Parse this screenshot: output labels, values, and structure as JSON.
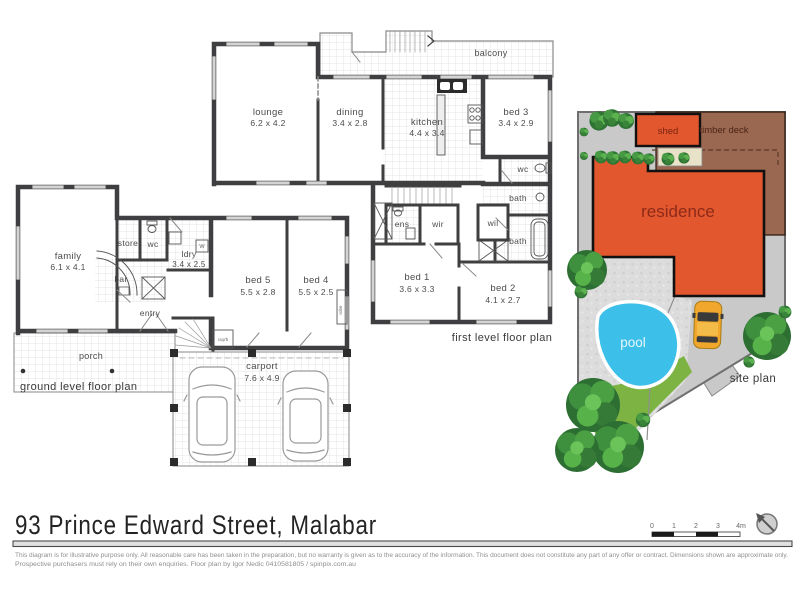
{
  "page": {
    "title": "93 Prince Edward Street, Malabar",
    "disclaimer_line1": "This diagram is for illustrative purpose only. All reasonable care has been taken in the preparation, but no warranty is given as to the accuracy of the information. This document does not constitute any part of any offer or contract. Dimensions shown are approximate only.",
    "disclaimer_line2": "Prospective purchasers must rely on their own enquiries. Floor plan by Igor Nedic 0410581805 / spinpix.com.au"
  },
  "ground_plan": {
    "label": "ground level floor plan",
    "family": {
      "name": "family",
      "dims": "6.1 x 4.1"
    },
    "store": {
      "name": "store"
    },
    "wc": {
      "name": "wc"
    },
    "ldry": {
      "name": "ldry",
      "dims": "3.4 x 2.5"
    },
    "bar": {
      "name": "bar"
    },
    "entry": {
      "name": "entry"
    },
    "porch": {
      "name": "porch"
    },
    "bed5": {
      "name": "bed 5",
      "dims": "5.5 x 2.8"
    },
    "bed4": {
      "name": "bed 4",
      "dims": "5.5 x 2.5"
    },
    "carport": {
      "name": "carport",
      "dims": "7.6 x 4.9"
    },
    "robe": {
      "name": "robe"
    },
    "cupb": {
      "name": "cup'b"
    },
    "washer": {
      "name": "W"
    }
  },
  "first_plan": {
    "label": "first level floor plan",
    "balcony": {
      "name": "balcony"
    },
    "lounge": {
      "name": "lounge",
      "dims": "6.2 x 4.2"
    },
    "dining": {
      "name": "dining",
      "dims": "3.4 x 2.8"
    },
    "kitchen": {
      "name": "kitchen",
      "dims": "4.4 x 3.4"
    },
    "bed3": {
      "name": "bed 3",
      "dims": "3.4 x 2.9"
    },
    "wc": {
      "name": "wc"
    },
    "bath_upper": {
      "name": "bath"
    },
    "wil": {
      "name": "wil"
    },
    "bath_lower": {
      "name": "bath"
    },
    "ens": {
      "name": "ens"
    },
    "wir": {
      "name": "wir"
    },
    "bed1": {
      "name": "bed 1",
      "dims": "3.6 x 3.3"
    },
    "bed2": {
      "name": "bed 2",
      "dims": "4.1 x 2.7"
    }
  },
  "site_plan": {
    "label": "site plan",
    "shed": "shed",
    "timber_deck": "timber deck",
    "residence": "residence",
    "pool": "pool"
  },
  "scale_bar": {
    "ticks": [
      "0",
      "1",
      "2",
      "3",
      "4m"
    ]
  },
  "colors": {
    "wall": "#3f3f41",
    "residence": "#e2572e",
    "timber_deck": "#9a6750",
    "pool": "#3cc0ea",
    "grass": "#7cb342",
    "car": "#f0a72b",
    "site_base": "#c9c9c9"
  }
}
